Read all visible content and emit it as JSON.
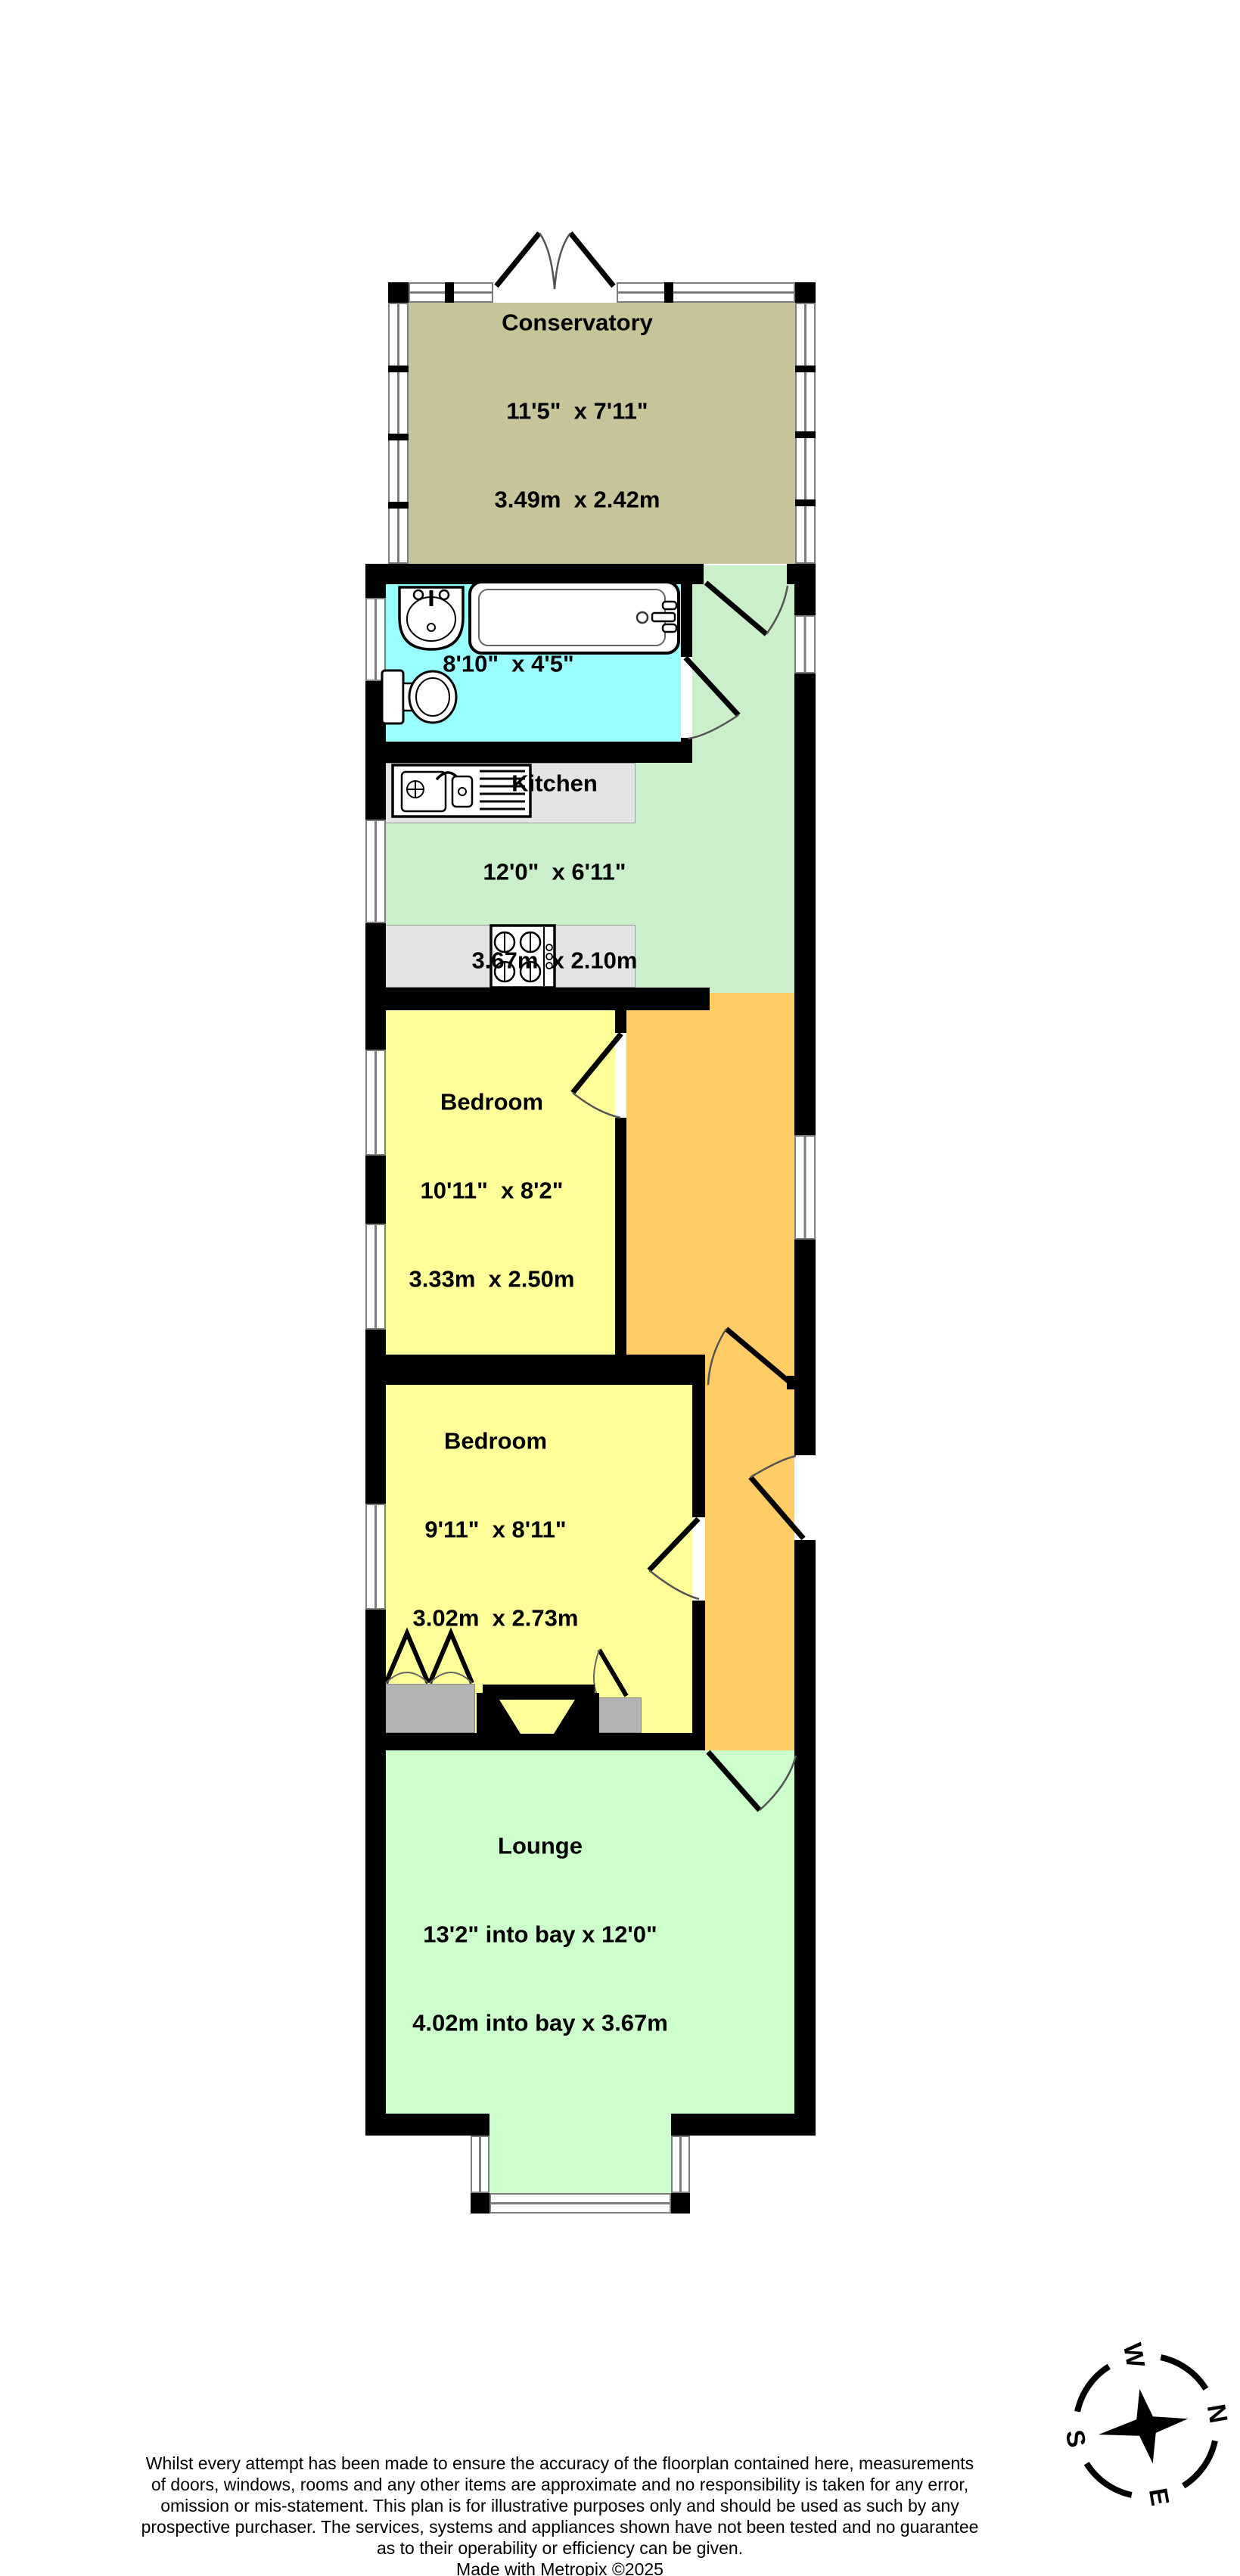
{
  "rooms": [
    {
      "name": "Conservatory",
      "imperial": "11'5\"  x 7'11\"",
      "metric": "3.49m  x 2.42m"
    },
    {
      "name": "Bathroom",
      "imperial": "8'10\"  x 4'5\"",
      "metric": "2.68m  x 1.34m"
    },
    {
      "name": "Kitchen",
      "imperial": "12'0\"  x 6'11\"",
      "metric": "3.67m  x 2.10m"
    },
    {
      "name": "Bedroom",
      "imperial": "10'11\"  x 8'2\"",
      "metric": "3.33m  x 2.50m"
    },
    {
      "name": "Bedroom",
      "imperial": "9'11\"  x 8'11\"",
      "metric": "3.02m  x 2.73m"
    },
    {
      "name": "Lounge",
      "imperial": "13'2\" into bay x 12'0\"",
      "metric": "4.02m into bay x 3.67m"
    }
  ],
  "compass": {
    "north": "N",
    "east": "E",
    "south": "S",
    "west": "W"
  },
  "colors": {
    "conservatory": "#c7c49a",
    "bathroom": "#99ffff",
    "kitchen": "#cbeecb",
    "lounge": "#ccffcc",
    "bedroom": "#ffff9a",
    "hallway": "#ffcc66",
    "closet": "#b3b3b3",
    "counter": "#e4e4e4",
    "wall": "#000000"
  },
  "footer": {
    "lines": [
      "Whilst every attempt has been made to ensure the accuracy of the floorplan contained here, measurements",
      "of doors, windows, rooms and any other items are approximate and no responsibility is taken for any error,",
      "omission or mis-statement. This plan is for illustrative purposes only and should be used as such by any",
      "prospective purchaser. The services, systems and appliances shown have not been tested and no guarantee",
      "as to their operability or efficiency can be given."
    ],
    "credit": "Made with Metropix ©2025"
  }
}
